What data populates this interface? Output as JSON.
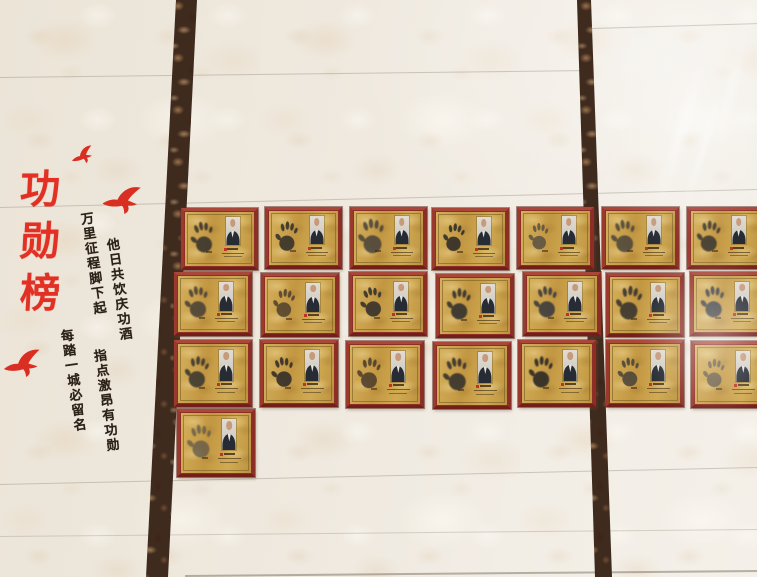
{
  "board": {
    "title": "功勋榜",
    "title_chars": [
      "功",
      "勋",
      "榜"
    ],
    "couplet": {
      "right_top": "他日共饮庆功酒",
      "right_bottom": "指点激昂有功勋",
      "left_top": "万里征程脚下起",
      "left_bottom": "每踏一城必留名"
    }
  },
  "colors": {
    "title_red": "#e33024",
    "bird_red": "#d92f23",
    "ink_black": "#2b2118",
    "frame_maroon": "#8e2f27",
    "plate_gold": "#c9a24e",
    "marble_brown": "#3f2a1e",
    "wall_cream": "#efe9df"
  },
  "birds": [
    {
      "x": 70,
      "y": 146,
      "w": 25,
      "rot": -16
    },
    {
      "x": 101,
      "y": 184,
      "w": 42,
      "rot": 0
    },
    {
      "x": 2,
      "y": 348,
      "w": 41,
      "rot": -6
    }
  ],
  "plaque_grid": {
    "rows": [
      {
        "y": 207,
        "h": 56,
        "w": 71,
        "plaques": [
          {
            "x": 181,
            "dy": 1,
            "hand": {
              "rot": -8,
              "tone": "#3a352e",
              "op": 0.9,
              "s": 1
            }
          },
          {
            "x": 265,
            "dy": 0,
            "hand": {
              "rot": 3,
              "tone": "#332f2a",
              "op": 0.88,
              "s": 0.95
            }
          },
          {
            "x": 350,
            "dy": 0,
            "hand": {
              "rot": -3,
              "tone": "#46413a",
              "op": 0.85,
              "s": 1.12
            }
          },
          {
            "x": 432,
            "dy": 1,
            "hand": {
              "rot": 7,
              "tone": "#322e28",
              "op": 0.9,
              "s": 0.9
            }
          },
          {
            "x": 517,
            "dy": 0,
            "hand": {
              "rot": 0,
              "tone": "#514c44",
              "op": 0.8,
              "s": 0.85
            }
          },
          {
            "x": 602,
            "dy": 0,
            "hand": {
              "rot": -5,
              "tone": "#45413b",
              "op": 0.82,
              "s": 1.05
            }
          },
          {
            "x": 687,
            "dy": 0,
            "hand": {
              "rot": 4,
              "tone": "#38342e",
              "op": 0.88,
              "s": 1
            }
          }
        ]
      },
      {
        "y": 272,
        "h": 58,
        "w": 72,
        "plaques": [
          {
            "x": 174,
            "dy": 0,
            "hand": {
              "rot": -5,
              "tone": "#433e37",
              "op": 0.85,
              "s": 1
            }
          },
          {
            "x": 261,
            "dy": 1,
            "hand": {
              "rot": 6,
              "tone": "#473a2b",
              "op": 0.8,
              "s": 0.9
            }
          },
          {
            "x": 349,
            "dy": 0,
            "hand": {
              "rot": -9,
              "tone": "#36322c",
              "op": 0.9,
              "s": 0.95
            }
          },
          {
            "x": 436,
            "dy": 2,
            "hand": {
              "rot": 2,
              "tone": "#30302f",
              "op": 0.88,
              "s": 1
            }
          },
          {
            "x": 523,
            "dy": 0,
            "hand": {
              "rot": -4,
              "tone": "#34363e",
              "op": 0.85,
              "s": 1
            }
          },
          {
            "x": 606,
            "dy": 1,
            "hand": {
              "rot": 6,
              "tone": "#3a352f",
              "op": 0.9,
              "s": 1.08
            }
          },
          {
            "x": 690,
            "dy": 0,
            "hand": {
              "rot": -2,
              "tone": "#323640",
              "op": 0.9,
              "s": 1
            }
          }
        ]
      },
      {
        "y": 340,
        "h": 61,
        "w": 72,
        "plaques": [
          {
            "x": 174,
            "dy": 0,
            "hand": {
              "rot": 5,
              "tone": "#3a362f",
              "op": 0.88,
              "s": 1
            }
          },
          {
            "x": 260,
            "dy": 0,
            "hand": {
              "rot": -6,
              "tone": "#332f29",
              "op": 0.9,
              "s": 0.95
            }
          },
          {
            "x": 346,
            "dy": 1,
            "hand": {
              "rot": 4,
              "tone": "#453729",
              "op": 0.82,
              "s": 0.98
            }
          },
          {
            "x": 433,
            "dy": 2,
            "hand": {
              "rot": -8,
              "tone": "#37332d",
              "op": 0.9,
              "s": 1.05
            }
          },
          {
            "x": 518,
            "dy": 0,
            "hand": {
              "rot": 3,
              "tone": "#302c27",
              "op": 0.92,
              "s": 1
            }
          },
          {
            "x": 606,
            "dy": 0,
            "hand": {
              "rot": -4,
              "tone": "#44403a",
              "op": 0.84,
              "s": 0.92
            }
          },
          {
            "x": 691,
            "dy": 1,
            "hand": {
              "rot": 2,
              "tone": "#534e46",
              "op": 0.75,
              "s": 0.9
            }
          }
        ]
      },
      {
        "y": 409,
        "h": 62,
        "w": 72,
        "plaques": [
          {
            "x": 177,
            "dy": 0,
            "hand": {
              "rot": -5,
              "tone": "#57524a",
              "op": 0.7,
              "s": 1.05
            }
          }
        ]
      }
    ]
  }
}
